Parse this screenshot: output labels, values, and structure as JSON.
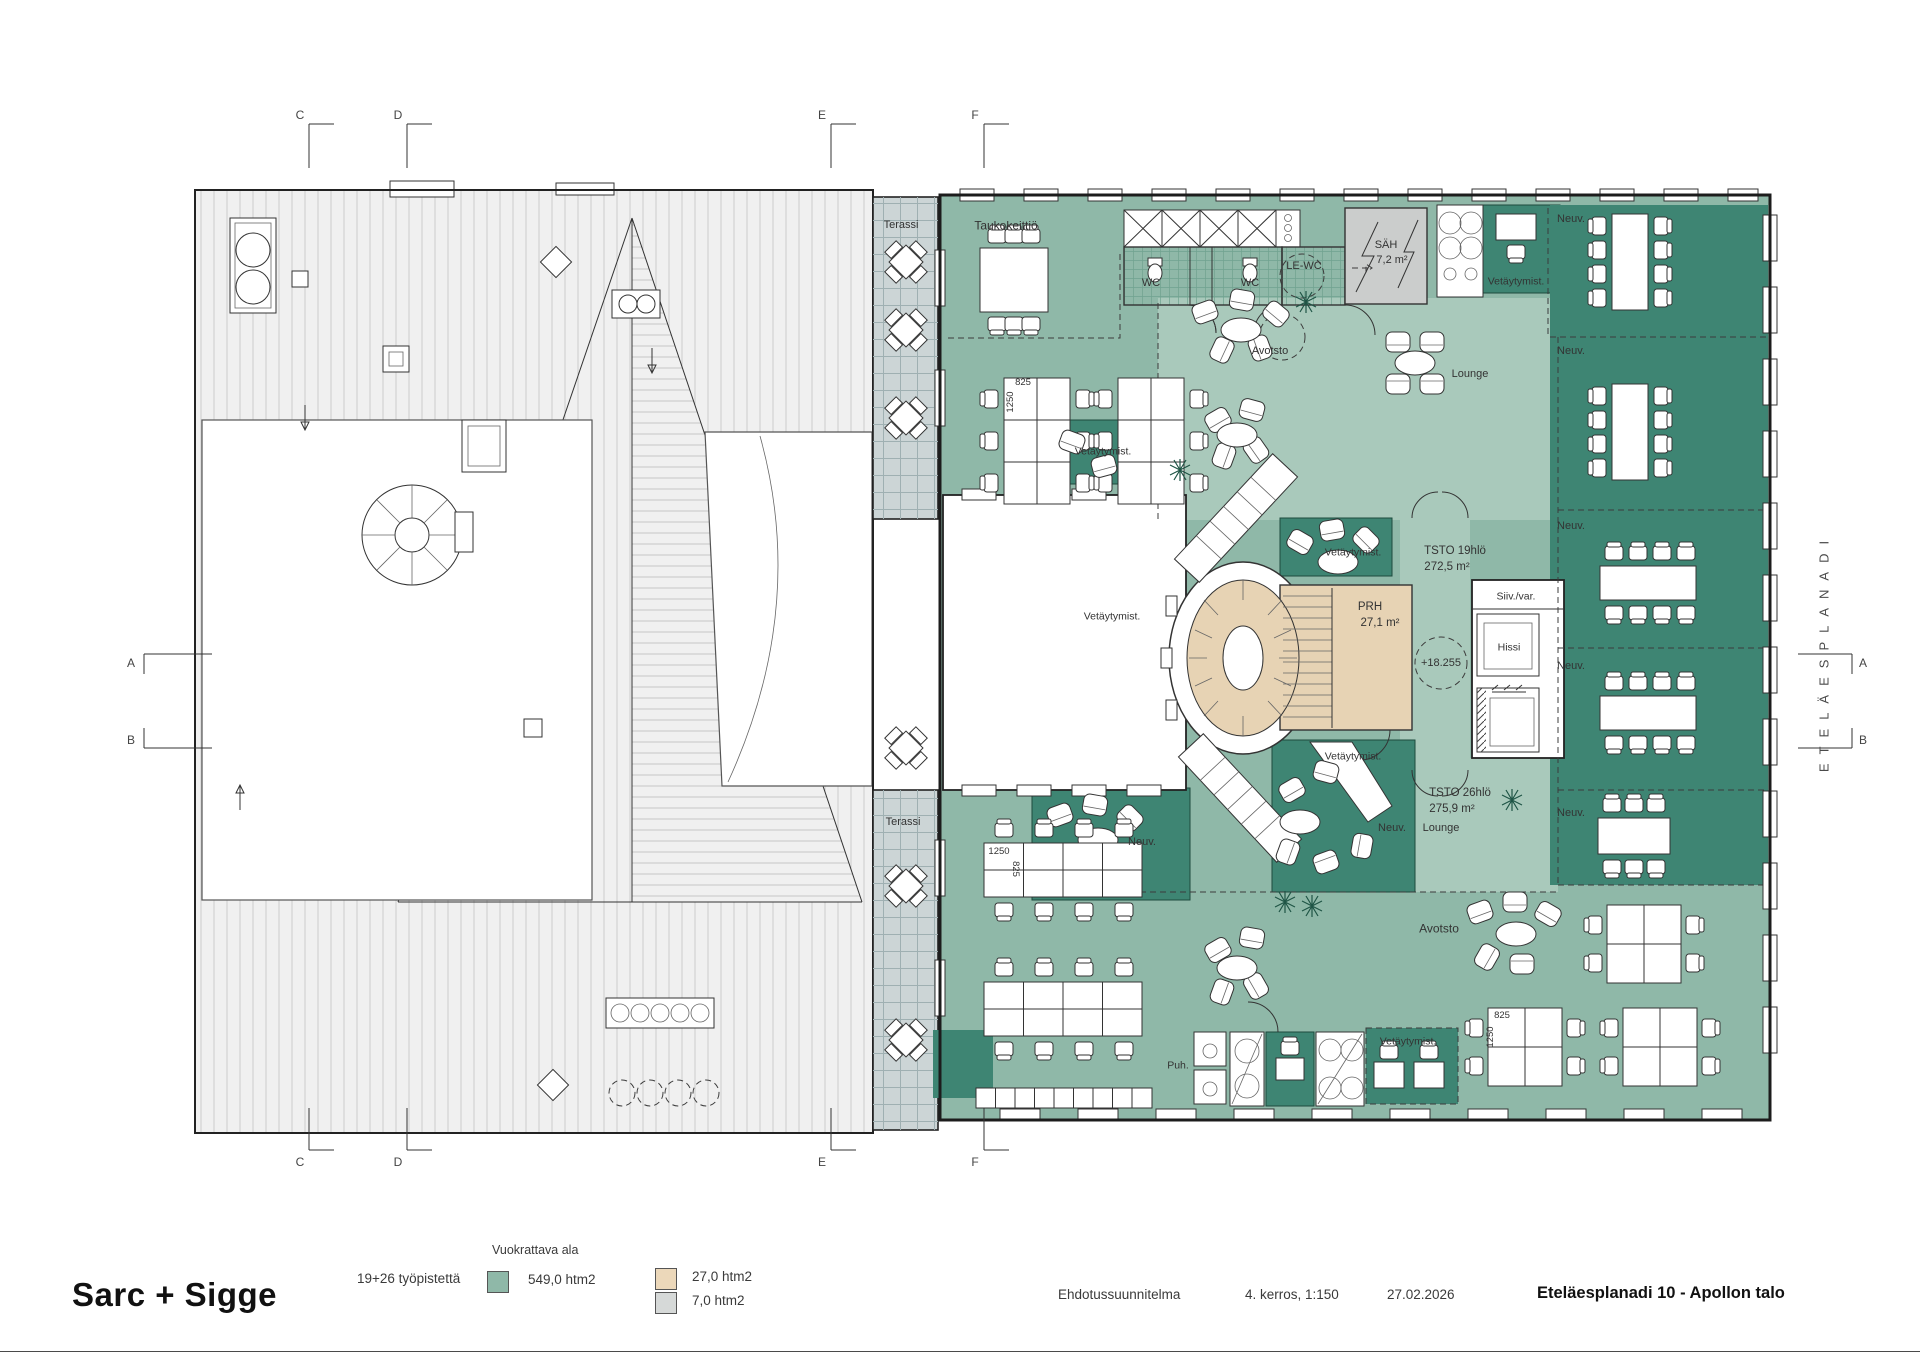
{
  "title_block": {
    "firm": "Sarc + Sigge",
    "doc_type": "Ehdotussuunnitelma",
    "floor_scale": "4. kerros, 1:150",
    "date": "27.02.2026",
    "project": "Eteläesplanadi 10 - Apollon talo"
  },
  "legend": {
    "title": "Vuokrattava ala",
    "workstations": "19+26 työpistettä",
    "items": [
      {
        "color": "#8fb8a8",
        "label": "549,0 htm2"
      },
      {
        "color": "#ecd8ba",
        "label": "27,0 htm2"
      },
      {
        "color": "#d6d9d8",
        "label": "7,0 htm2"
      }
    ]
  },
  "street": "ETELÄESPLANADI",
  "grid": {
    "cols": [
      "C",
      "D",
      "E",
      "F"
    ],
    "rows": [
      "A",
      "B"
    ]
  },
  "colors": {
    "office_mid_green": "#8fb8a8",
    "zone_light_green": "#a9c9bb",
    "room_dark_green": "#3e8573",
    "stair_tan": "#e7d3b4",
    "tech_gray": "#cbcdcc",
    "terrace_gray": "#ccd5d6"
  },
  "plan": {
    "labels": [
      {
        "n": "terassi-top",
        "t": "Terassi",
        "x": 901,
        "y": 226,
        "s": 11
      },
      {
        "n": "terassi-bottom",
        "t": "Terassi",
        "x": 903,
        "y": 823,
        "s": 11
      },
      {
        "n": "taukokeittio",
        "t": "Taukokeittiö",
        "x": 1006,
        "y": 226
      },
      {
        "n": "wc-left",
        "t": "WC",
        "x": 1151,
        "y": 284,
        "s": 11
      },
      {
        "n": "wc-right",
        "t": "WC",
        "x": 1250,
        "y": 284,
        "s": 11
      },
      {
        "n": "le-wc",
        "t": "LE-WC",
        "x": 1304,
        "y": 267,
        "s": 11
      },
      {
        "n": "sah",
        "t": "SÄH",
        "x": 1386,
        "y": 246,
        "s": 11
      },
      {
        "n": "sah-area",
        "t": "7,2 m²",
        "x": 1392,
        "y": 261,
        "s": 11
      },
      {
        "n": "avotsto-top",
        "t": "Avotsto",
        "x": 1270,
        "y": 352,
        "s": 11
      },
      {
        "n": "avotsto-bottom",
        "t": "Avotsto",
        "x": 1439,
        "y": 929
      },
      {
        "n": "lounge-top",
        "t": "Lounge",
        "x": 1470,
        "y": 375,
        "s": 11
      },
      {
        "n": "lounge-bottom",
        "t": "Lounge",
        "x": 1441,
        "y": 829,
        "s": 11
      },
      {
        "n": "vetaytymist-1",
        "t": "Vetäytymist.",
        "x": 1516,
        "y": 282,
        "s": 10.5
      },
      {
        "n": "vetaytymist-2",
        "t": "Vetäytymist.",
        "x": 1103,
        "y": 452,
        "s": 10.5
      },
      {
        "n": "vetaytymist-3",
        "t": "Vetäytymist.",
        "x": 1353,
        "y": 553,
        "s": 10.5
      },
      {
        "n": "vetaytymist-4",
        "t": "Vetäytymist.",
        "x": 1112,
        "y": 617,
        "s": 10.5
      },
      {
        "n": "vetaytymist-5",
        "t": "Vetäytymist.",
        "x": 1353,
        "y": 757,
        "s": 10.5
      },
      {
        "n": "vetaytymist-6",
        "t": "Vetäytymist.",
        "x": 1408,
        "y": 1042,
        "s": 10.5
      },
      {
        "n": "neuv-1",
        "t": "Neuv.",
        "x": 1571,
        "y": 220,
        "s": 11
      },
      {
        "n": "neuv-2",
        "t": "Neuv.",
        "x": 1571,
        "y": 352,
        "s": 11
      },
      {
        "n": "neuv-3",
        "t": "Neuv.",
        "x": 1571,
        "y": 527,
        "s": 11
      },
      {
        "n": "neuv-4",
        "t": "Neuv.",
        "x": 1571,
        "y": 667,
        "s": 11
      },
      {
        "n": "neuv-5",
        "t": "Neuv.",
        "x": 1571,
        "y": 814,
        "s": 11
      },
      {
        "n": "neuv-6",
        "t": "Neuv.",
        "x": 1392,
        "y": 829,
        "s": 11
      },
      {
        "n": "neuv-7",
        "t": "Neuv.",
        "x": 1142,
        "y": 843,
        "s": 11
      },
      {
        "n": "tsto19",
        "t": "TSTO 19hlö",
        "x": 1455,
        "y": 551,
        "s": 11.5
      },
      {
        "n": "tsto19-area",
        "t": "272,5 m²",
        "x": 1447,
        "y": 567,
        "s": 11.5
      },
      {
        "n": "tsto26",
        "t": "TSTO 26hlö",
        "x": 1460,
        "y": 793,
        "s": 11.5
      },
      {
        "n": "tsto26-area",
        "t": "275,9 m²",
        "x": 1452,
        "y": 809,
        "s": 11.5
      },
      {
        "n": "prh",
        "t": "PRH",
        "x": 1370,
        "y": 607,
        "s": 11.5
      },
      {
        "n": "prh-area",
        "t": "27,1 m²",
        "x": 1380,
        "y": 623,
        "s": 11.5
      },
      {
        "n": "hissi",
        "t": "Hissi",
        "x": 1509,
        "y": 648,
        "s": 10.5
      },
      {
        "n": "siiv-var",
        "t": "Siiv./var.",
        "x": 1516,
        "y": 597,
        "s": 10.5
      },
      {
        "n": "level",
        "t": "+18.255",
        "x": 1441,
        "y": 664,
        "s": 11
      },
      {
        "n": "puh",
        "t": "Puh.",
        "x": 1178,
        "y": 1066,
        "s": 10.5
      },
      {
        "n": "dim-825-top",
        "t": "825",
        "x": 1023,
        "y": 383,
        "s": 9.5
      },
      {
        "n": "dim-1250-top",
        "t": "1250",
        "x": 1011,
        "y": 402,
        "s": 9.5,
        "r": -90
      },
      {
        "n": "dim-1250-bl",
        "t": "1250",
        "x": 999,
        "y": 852,
        "s": 9.5
      },
      {
        "n": "dim-825-bl",
        "t": "825",
        "x": 1015,
        "y": 869,
        "s": 9.5,
        "r": 90
      },
      {
        "n": "dim-825-br",
        "t": "825",
        "x": 1502,
        "y": 1016,
        "s": 9.5
      },
      {
        "n": "dim-1250-br",
        "t": "1250",
        "x": 1491,
        "y": 1037,
        "s": 9.5,
        "r": -90
      }
    ]
  }
}
